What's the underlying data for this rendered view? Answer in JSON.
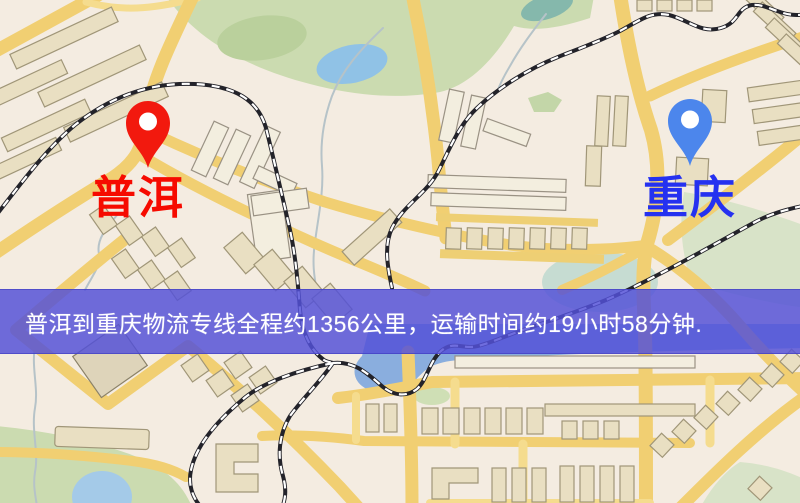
{
  "banner": {
    "text": "普洱到重庆物流专线全程约1356公里，运输时间约19小时58分钟.",
    "background_color": "#5451d8",
    "text_color": "#ffffff"
  },
  "markers": {
    "origin": {
      "label": "普洱",
      "pin_color": "#f2190e",
      "label_color": "#f60b00"
    },
    "destination": {
      "label": "重庆",
      "pin_color": "#4c86ec",
      "label_color": "#2531f0"
    }
  },
  "map_colors": {
    "land": "#f4ece1",
    "road": "#f1cf72",
    "road_minor": "#f5dc8e",
    "park": "#cbdbb0",
    "water": "#8aaede",
    "building": "#e9dfc2",
    "railway": "#23232a"
  }
}
